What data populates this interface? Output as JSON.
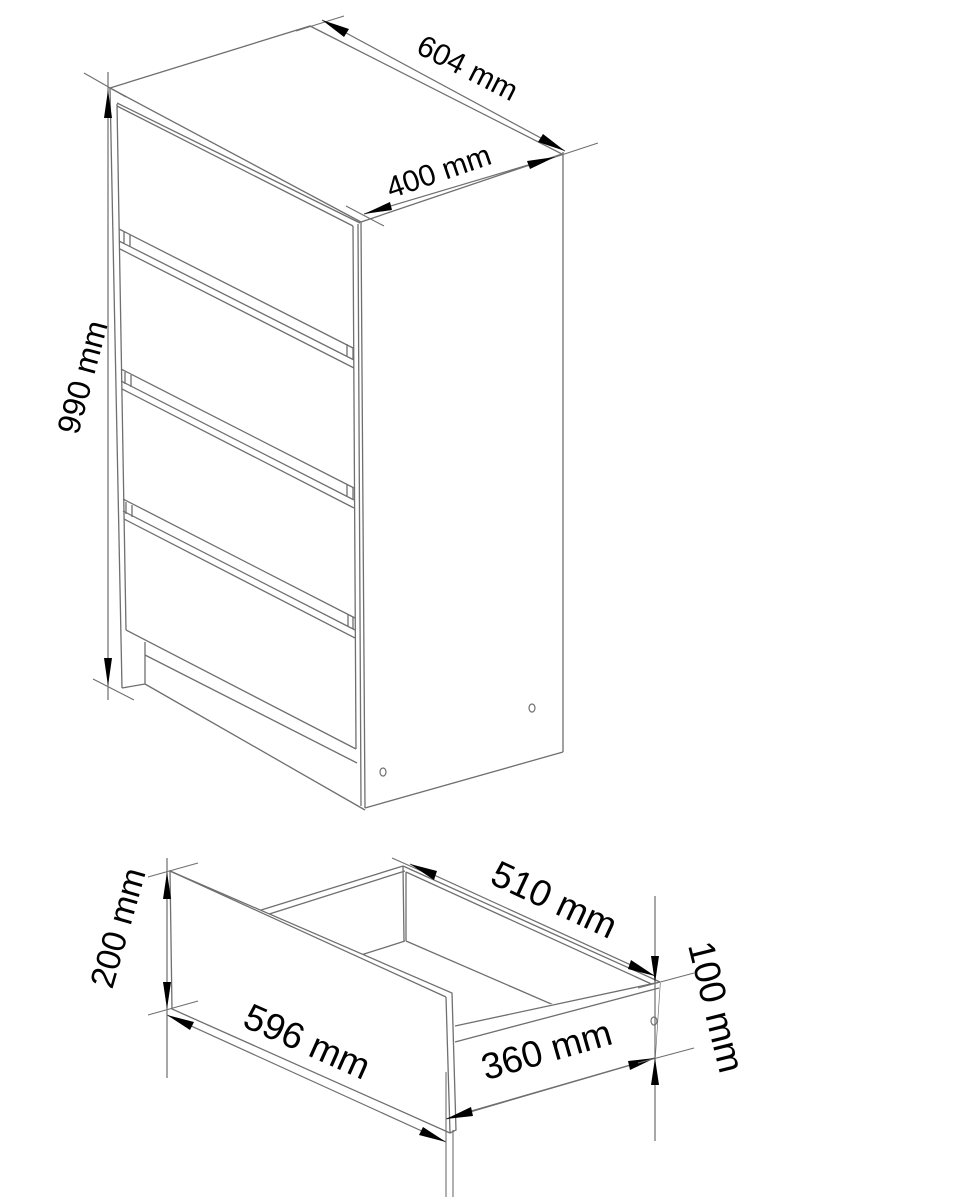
{
  "diagram": {
    "background": "#ffffff",
    "line_color": "#6f6f6f",
    "arrow_color": "#000000",
    "text_color": "#000000",
    "cabinet": {
      "type": "chest-of-drawers",
      "drawer_count": 4,
      "dimensions": {
        "width": {
          "value": 604,
          "unit": "mm",
          "label": "604 mm"
        },
        "depth": {
          "value": 400,
          "unit": "mm",
          "label": "400 mm"
        },
        "height": {
          "value": 990,
          "unit": "mm",
          "label": "990 mm"
        }
      }
    },
    "drawer": {
      "type": "drawer-open-box",
      "dimensions": {
        "front_width": {
          "value": 596,
          "unit": "mm",
          "label": "596 mm"
        },
        "front_height": {
          "value": 200,
          "unit": "mm",
          "label": "200 mm"
        },
        "inner_width": {
          "value": 510,
          "unit": "mm",
          "label": "510 mm"
        },
        "inner_depth": {
          "value": 360,
          "unit": "mm",
          "label": "360 mm"
        },
        "side_height": {
          "value": 100,
          "unit": "mm",
          "label": "100 mm"
        }
      }
    }
  }
}
